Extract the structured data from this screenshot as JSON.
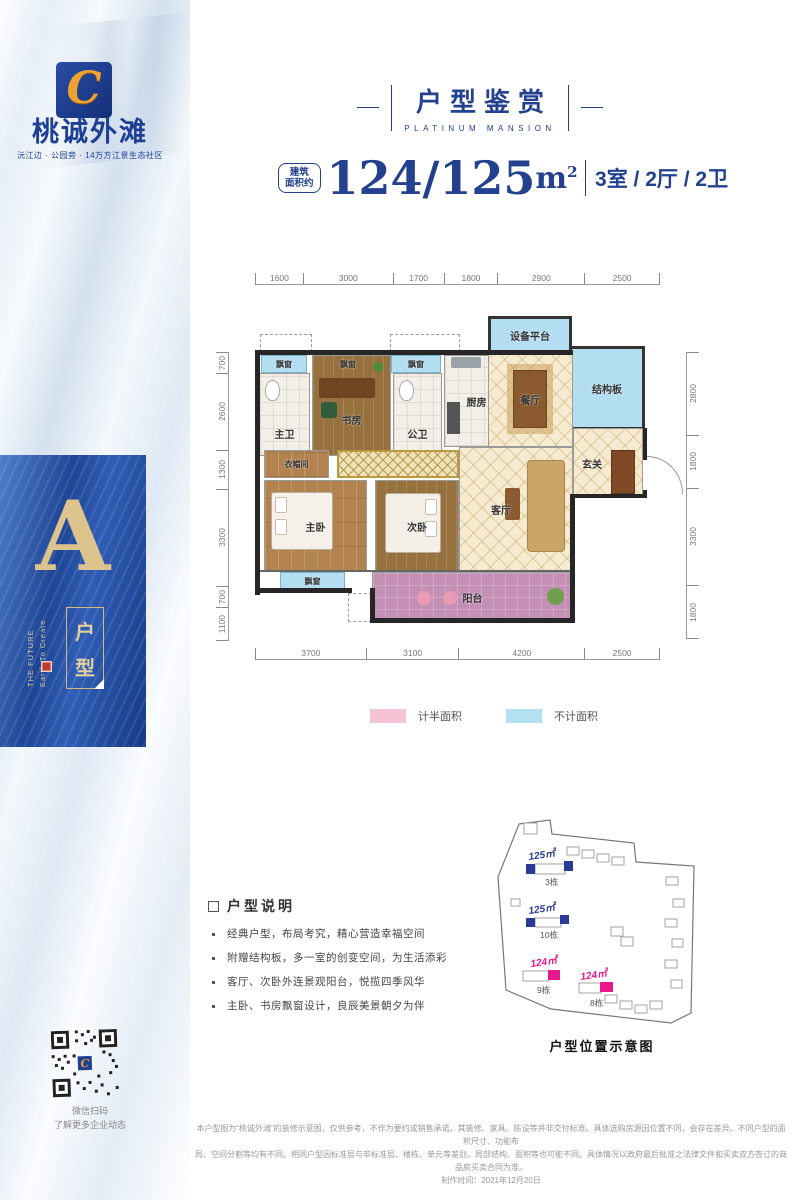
{
  "brand": {
    "logo_mark": "C",
    "name": "桃诚外滩",
    "tagline": "沅江边 · 公园旁 · 14万方江景生态社区"
  },
  "sidebar": {
    "plan_letter": "A",
    "plan_letter_en1": "Earth To Create",
    "plan_letter_en2": "THE FUTURE",
    "unit_box_char1": "户",
    "unit_box_char2": "型",
    "qr_caption1": "微信扫码",
    "qr_caption2": "了解更多企业动态"
  },
  "header": {
    "title": "户型鉴赏",
    "subtitle": "PLATINUM MANSION"
  },
  "spec": {
    "prefix1": "建筑",
    "prefix2": "面积约",
    "value": "124/125",
    "unit": "m",
    "unit_sup": "2",
    "rooms": "3室 / 2厅 / 2卫"
  },
  "floorplan": {
    "dims_top": [
      "1600",
      "3000",
      "1700",
      "1800",
      "2900",
      "2500"
    ],
    "dims_left": [
      "700",
      "2600",
      "1300",
      "3300",
      "700",
      "1100"
    ],
    "dims_right": [
      "2800",
      "1800",
      "3300",
      "1800"
    ],
    "dims_bottom": [
      "3700",
      "3100",
      "4200",
      "2500"
    ],
    "rooms": {
      "equipment": "设备平台",
      "structural": "结构板",
      "bay": "飘窗",
      "master_bath": "主卫",
      "study": "书房",
      "guest_bath": "公卫",
      "kitchen": "厨房",
      "dining": "餐厅",
      "foyer": "玄关",
      "cloakroom": "衣帽间",
      "master_bed": "主卧",
      "second_bed": "次卧",
      "living": "客厅",
      "balcony": "阳台"
    },
    "legend": [
      {
        "label": "计半面积",
        "color": "#f5c3d6"
      },
      {
        "label": "不计面积",
        "color": "#b5dff2"
      }
    ]
  },
  "description": {
    "title": "户型说明",
    "bullets": [
      "经典户型，布局考究，精心营造幸福空间",
      "附赠结构板，多一室的创变空间，为生活添彩",
      "客厅、次卧外连景观阳台，悦揽四季风华",
      "主卧、书房飘窗设计，良辰美景朝夕为伴"
    ]
  },
  "siteplan": {
    "caption": "户型位置示意图",
    "markers": [
      {
        "area": "125㎡",
        "building": "3栋",
        "color": "#2b3a94"
      },
      {
        "area": "125㎡",
        "building": "10栋",
        "color": "#2b3a94"
      },
      {
        "area": "124㎡",
        "building": "9栋",
        "color": "#e8188b"
      },
      {
        "area": "124㎡",
        "building": "8栋",
        "color": "#e8188b"
      }
    ]
  },
  "footer": {
    "line1": "本户型图为“桃诚外滩”的装修示意图，仅供参考，不作为要约或销售承诺。其装修、家具、陈设等并非交付标准。具体选购房源因位置不同，会存在差异。不同户型的面积尺寸、功能布",
    "line2": "局、空间分割等均有不同。相同户型因标准层与非标准层、楼栋、单元等差别，局部结构、面积等也可能不同。具体情况以政府最后批准之法律文件和买卖双方签订的商品房买卖合同为准。",
    "line3": "制作时间：2021年12月20日"
  }
}
